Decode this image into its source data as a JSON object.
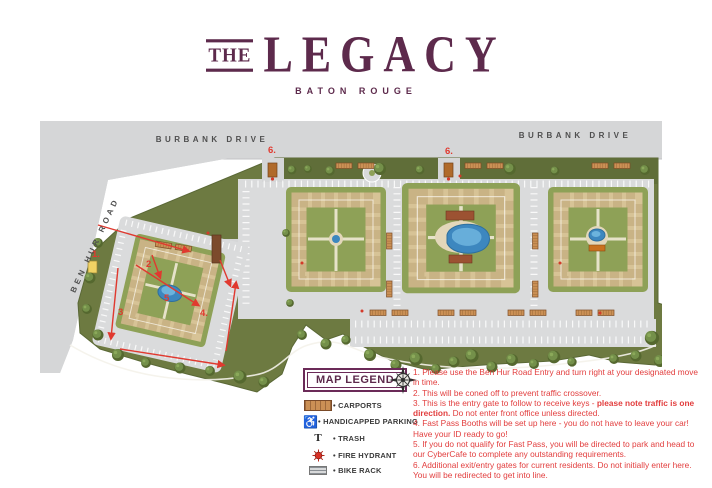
{
  "header": {
    "the": "THE",
    "legacy": "LEGACY",
    "subtitle": "BATON ROUGE"
  },
  "map": {
    "roads": {
      "burbank_left": "BURBANK DRIVE",
      "burbank_right": "BURBANK DRIVE",
      "ben_hur": "BEN HUR ROAD"
    },
    "markers": [
      {
        "label": "1."
      },
      {
        "label": "2"
      },
      {
        "label": "3"
      },
      {
        "label": "4."
      },
      {
        "label": "5"
      },
      {
        "label": "6."
      },
      {
        "label": "6."
      }
    ]
  },
  "legend": {
    "title": "MAP LEGEND",
    "items": [
      {
        "icon": "carport-icon",
        "label": "CARPORTS"
      },
      {
        "icon": "handicapped-icon",
        "label": "HANDICAPPED PARKING",
        "glyph": "♿"
      },
      {
        "icon": "trash-icon",
        "label": "TRASH",
        "glyph": "T"
      },
      {
        "icon": "fire-hydrant-icon",
        "label": "FIRE HYDRANT"
      },
      {
        "icon": "bike-rack-icon",
        "label": "BIKE RACK"
      }
    ]
  },
  "instructions": [
    {
      "text": "1. Please use the Ben Hur Road Entry and turn right at your designated move in time."
    },
    {
      "text": "2. This will be coned off to prevent traffic crossover."
    },
    {
      "pre": "3. This is the entry gate to follow to receive keys - ",
      "bold": "please note traffic is one direction.",
      "post": " Do not enter front office unless directed."
    },
    {
      "text": "4. Fast Pass Booths will be set up here - you do not have to leave your car! Have your ID ready to go!"
    },
    {
      "text": "5. If you do not qualify for Fast Pass, you will be directed to park and head to our CyberCafe to complete any outstanding requirements."
    },
    {
      "text": "6. Additional exit/entry gates for current residents. Do not initially enter here. You will be redirected to get into line."
    }
  ],
  "colors": {
    "brand_purple": "#5d2a4c",
    "alert_red": "#e23d3d",
    "site_green": "#6d7a41",
    "road_gray": "#d5d6d7",
    "pool_blue": "#3d87bf",
    "building_tan": "#d7c396",
    "carport_brown": "#cb9055"
  }
}
